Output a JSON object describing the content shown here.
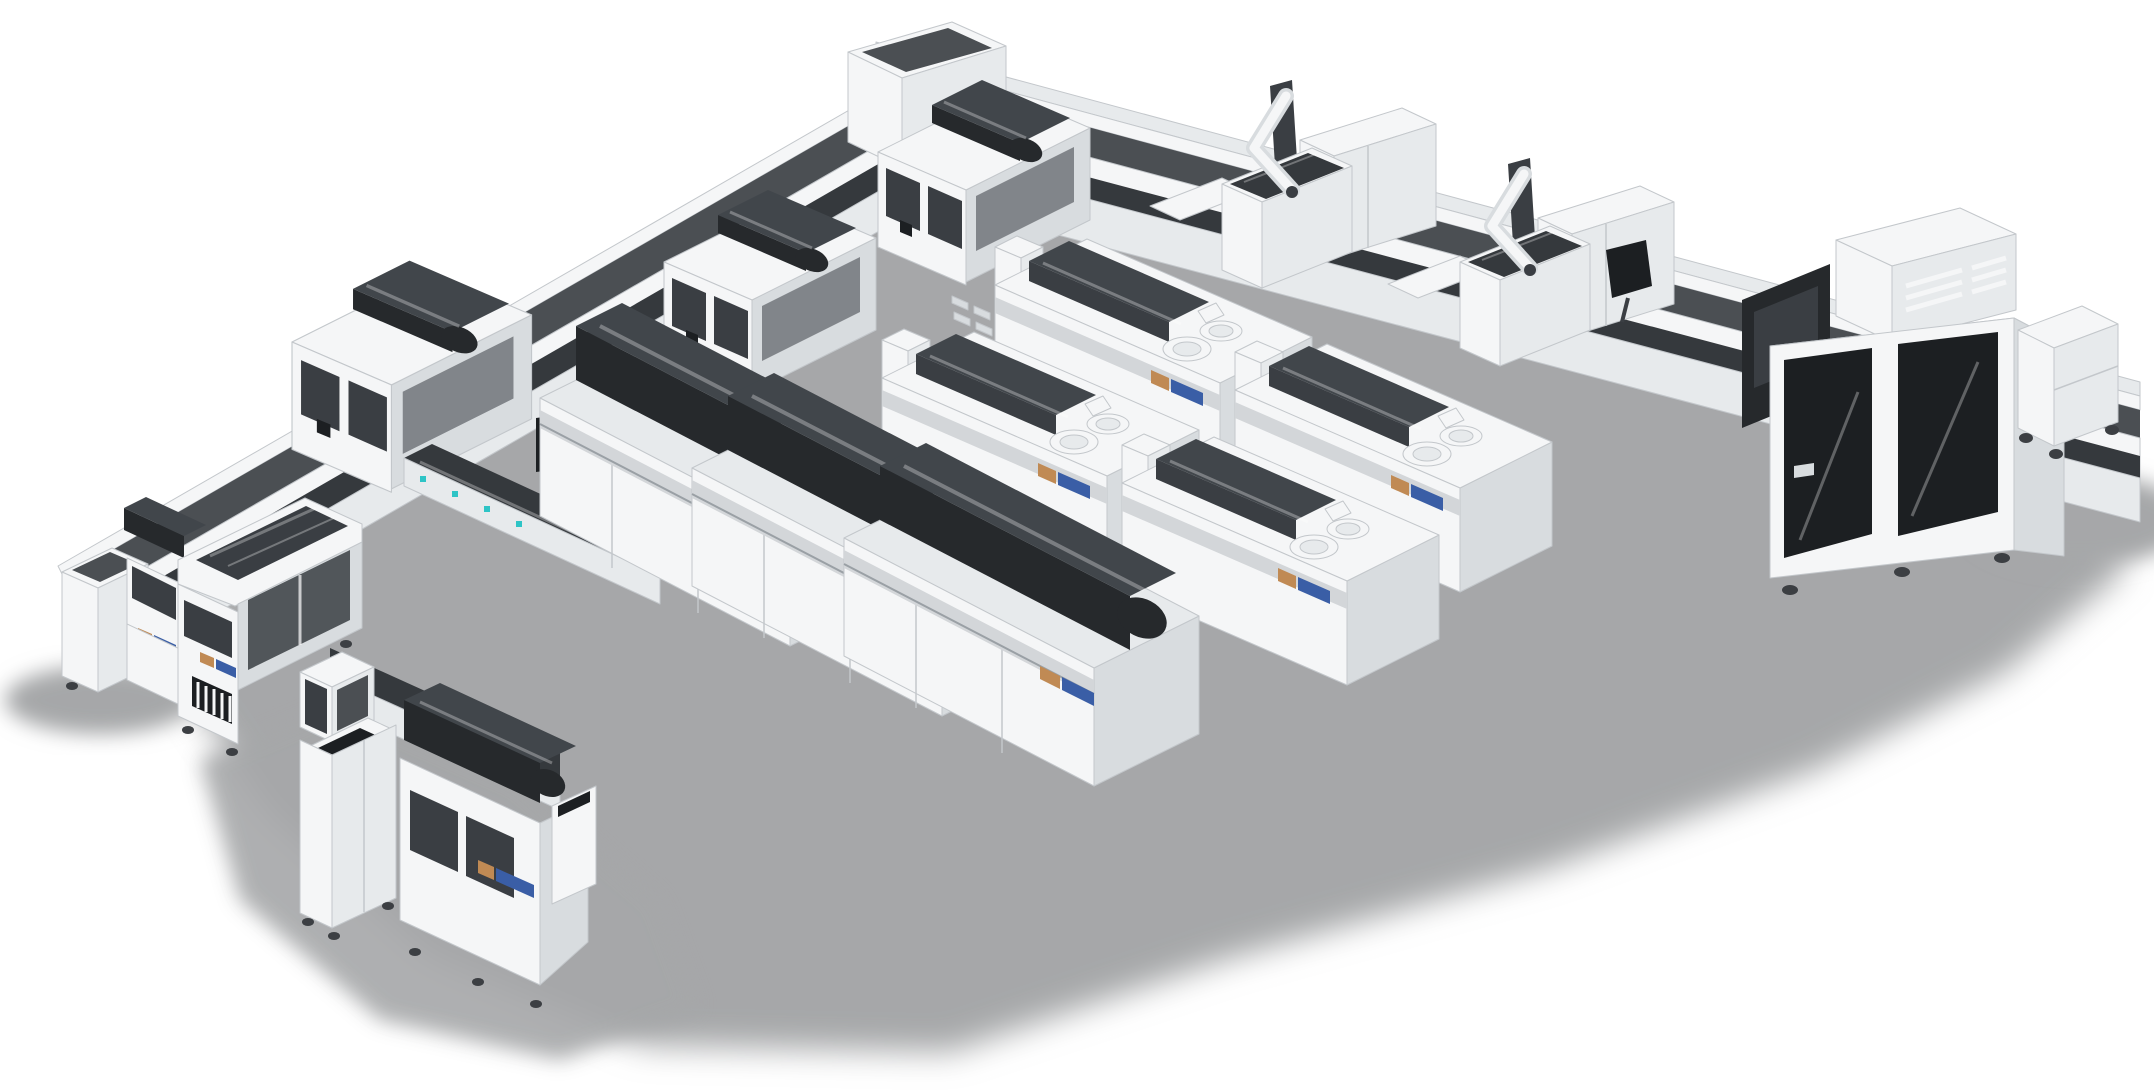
{
  "meta": {
    "description": "Isometric 3D product rendering of a modular clinical laboratory automation system: white analyzer modules with dark smoked-glass covers linked by a U-shaped sample-transport track, two robotic-arm workcells, a tall sample-archive cabinet with dark glass doors, and standalone analyzers and a sorting kiosk in the foreground, on a plain white background with soft gray floor shadows."
  },
  "palette": {
    "body": "#f5f6f7",
    "shade": "#e7eaec",
    "side": "#d8dcdf",
    "edge": "#c3c7cb",
    "coverblack": "#26292c",
    "coverhi": "#41464b",
    "glass": "#3a3e43",
    "glasshi": "#61666c",
    "tracktop": "#4b4f53",
    "trackdark": "#35393d",
    "rail": "#d3d6d9",
    "cavity": "#1c1f22",
    "floor": "#a6a7a9",
    "blue": "#3a5ea6",
    "orange": "#c08a54",
    "screen": "#cdd1f1",
    "teal": "#2ec4c6",
    "casterdark": "#3c3f43"
  },
  "scene": {
    "modules": [
      {
        "id": "conveyor-track-left-arm",
        "kind": "sample transport track"
      },
      {
        "id": "conveyor-track-right-arm",
        "kind": "sample transport track"
      },
      {
        "id": "track-corner-junction",
        "kind": "track junction box"
      },
      {
        "id": "bridge-module-1",
        "kind": "sample processing bridge"
      },
      {
        "id": "bridge-module-2",
        "kind": "sample processing bridge"
      },
      {
        "id": "bridge-module-3",
        "kind": "sample processing bridge"
      },
      {
        "id": "loading-deck",
        "kind": "sample loading deck"
      },
      {
        "id": "operator-monitor",
        "kind": "display screen"
      },
      {
        "id": "chemistry-analyzer-1",
        "kind": "analyzer with black cover"
      },
      {
        "id": "chemistry-analyzer-2",
        "kind": "analyzer with black cover"
      },
      {
        "id": "chemistry-analyzer-3",
        "kind": "analyzer with black cover"
      },
      {
        "id": "immunoassay-analyzer-1",
        "kind": "analyzer with reagent carousels"
      },
      {
        "id": "immunoassay-analyzer-2",
        "kind": "analyzer with reagent carousels"
      },
      {
        "id": "immunoassay-analyzer-3",
        "kind": "analyzer with reagent carousels"
      },
      {
        "id": "immunoassay-analyzer-4",
        "kind": "analyzer with reagent carousels"
      },
      {
        "id": "robotic-arm-station-1",
        "kind": "robotic arm workcell"
      },
      {
        "id": "robotic-arm-station-2",
        "kind": "robotic arm workcell"
      },
      {
        "id": "wall-display-panel",
        "kind": "angled dark panel on track"
      },
      {
        "id": "sample-archive-cabinet",
        "kind": "tall storage cabinet with dark glass doors"
      },
      {
        "id": "supply-cart",
        "kind": "wheeled cart"
      },
      {
        "id": "track-end-cabinet",
        "kind": "track end cap cabinet"
      },
      {
        "id": "rear-bridge-analyzer",
        "kind": "analyzer"
      },
      {
        "id": "left-bridge-analyzer",
        "kind": "large analyzer with smoked glass cover"
      },
      {
        "id": "sorting-kiosk",
        "kind": "sample sorting kiosk with glass hood"
      },
      {
        "id": "front-analyzer",
        "kind": "analyzer with dark cover and side bin"
      }
    ],
    "accents": {
      "label_strip_colors": [
        "#c08a54",
        "#3a5ea6"
      ],
      "status_dot_color": "#2ec4c6",
      "monitor_screen_color": "#cdd1f1"
    }
  }
}
